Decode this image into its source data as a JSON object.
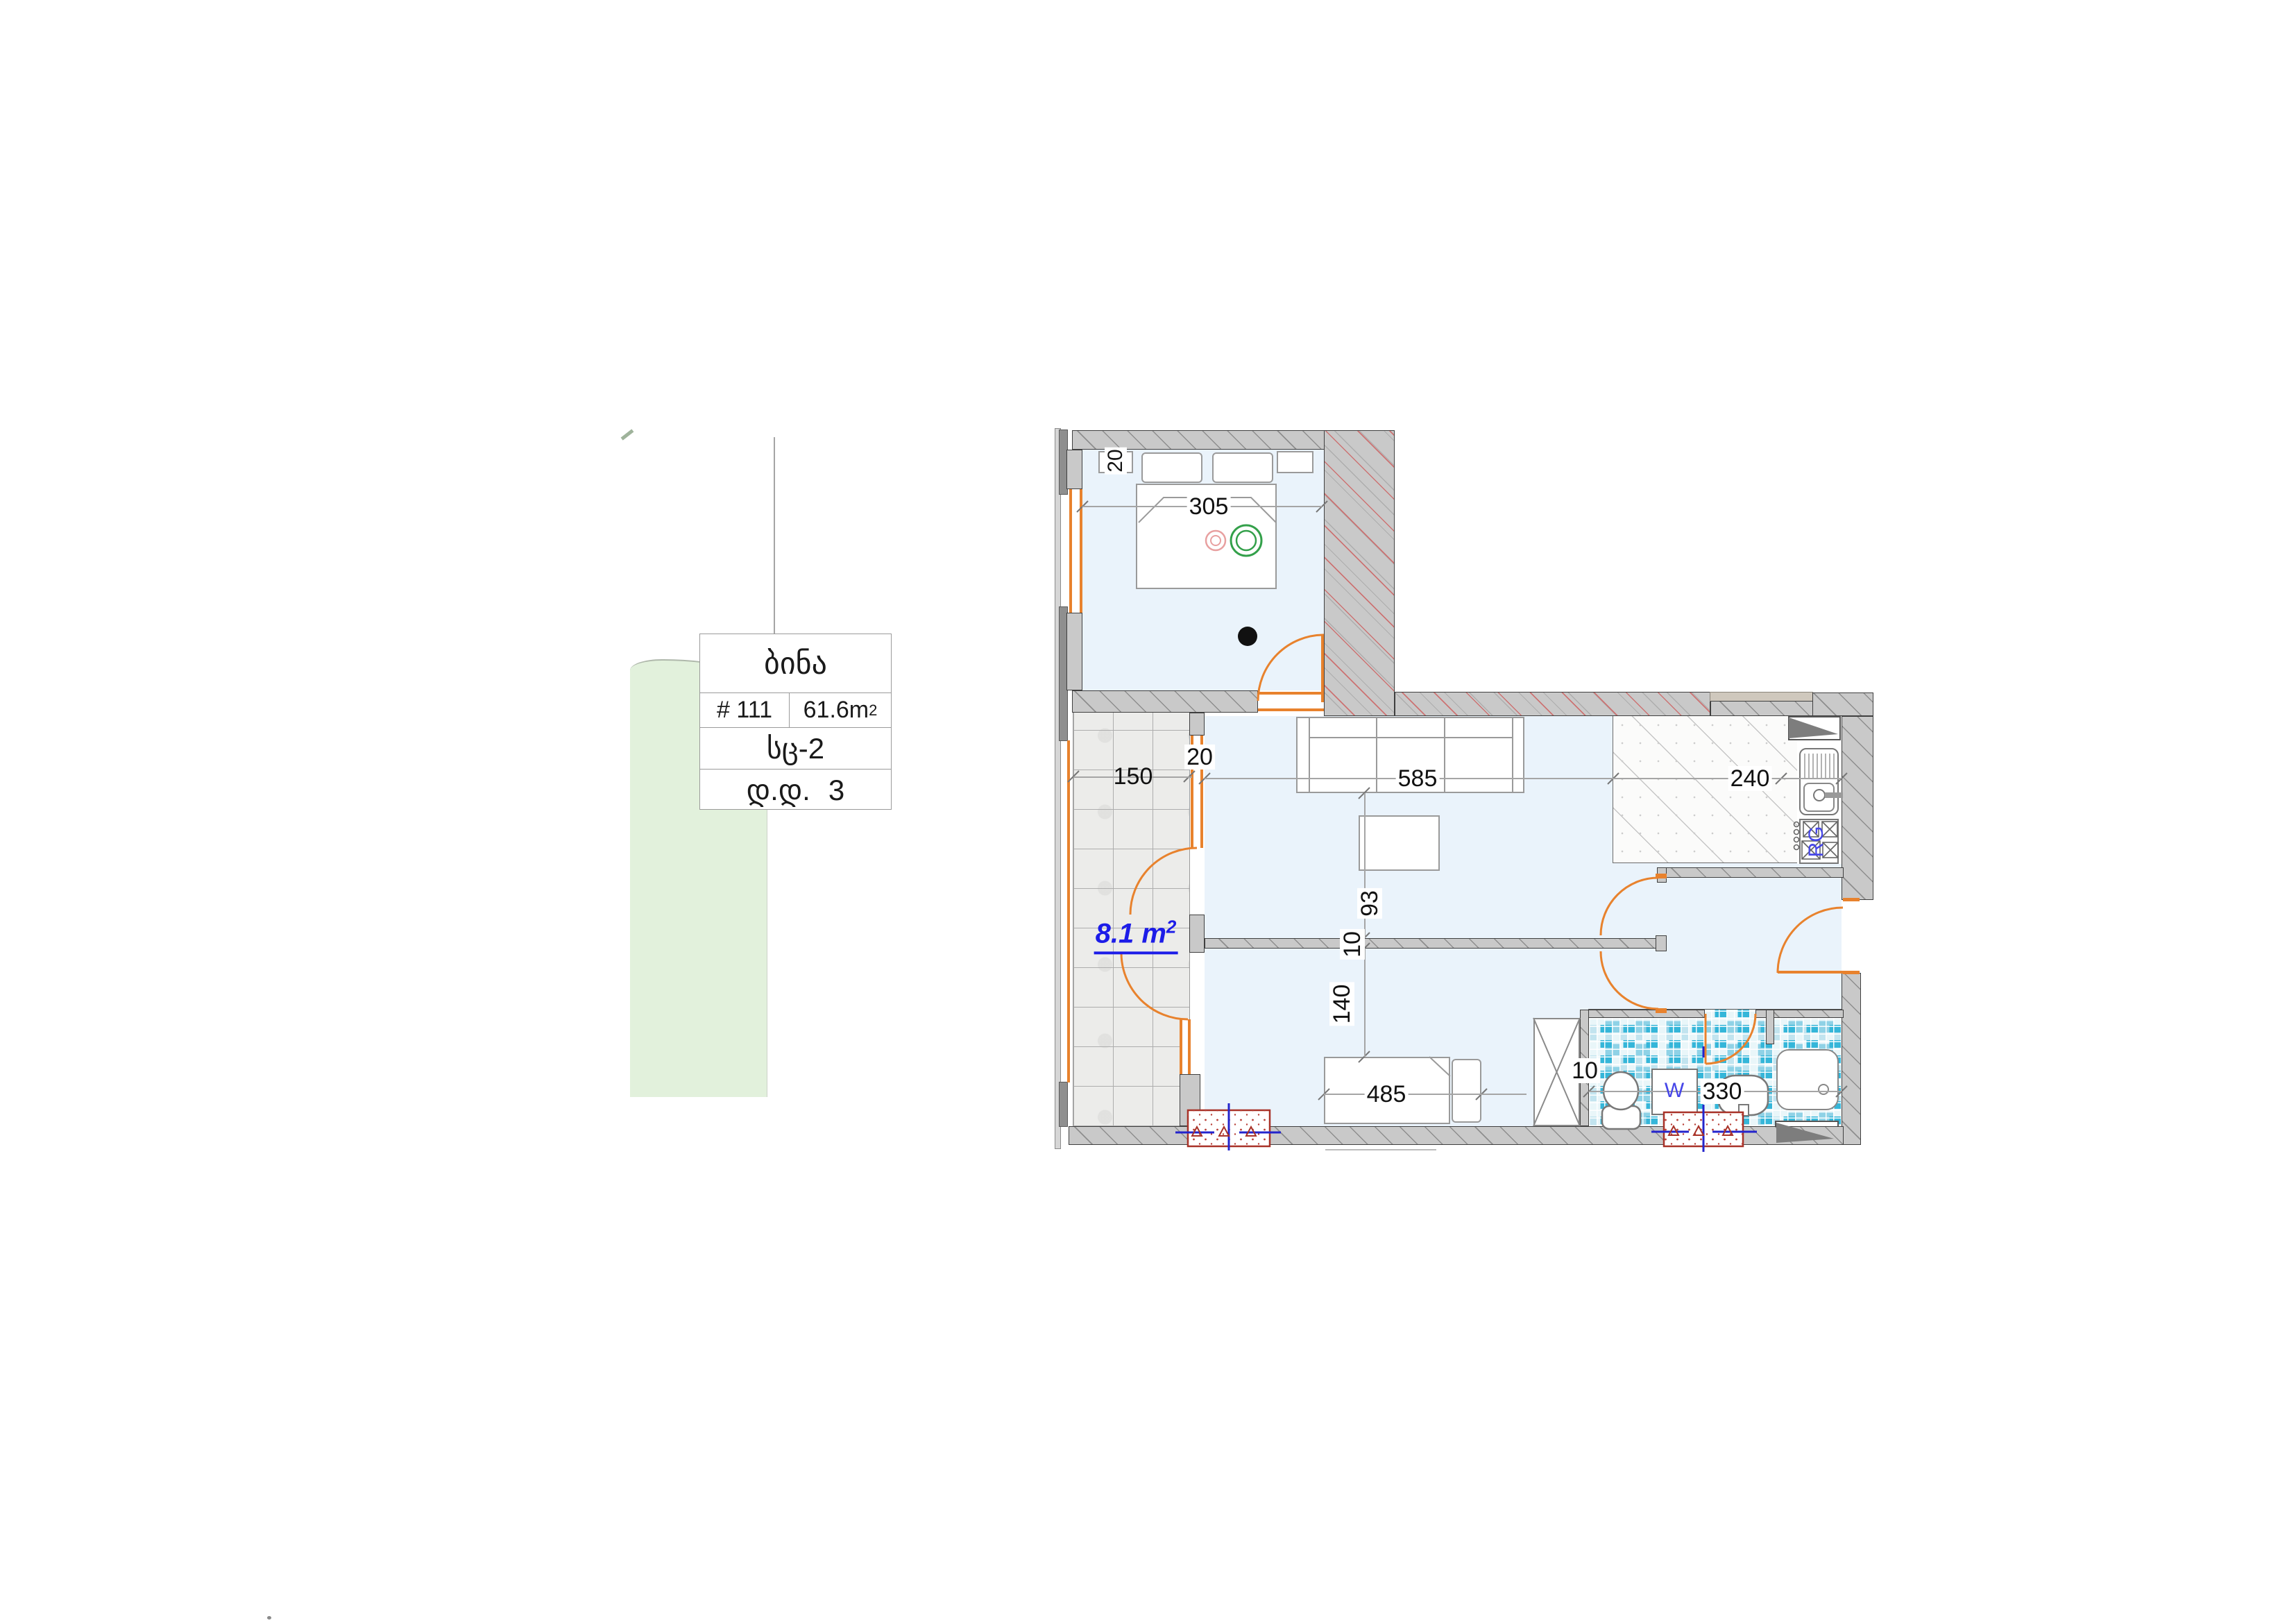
{
  "info_table": {
    "title": "ბინა",
    "apartment_number": "# 111",
    "area_value": "61.6m",
    "area_sup": "2",
    "section": "სც-2",
    "floor_prefix": "დ.დ.",
    "floor_number": "3"
  },
  "plan": {
    "balcony_area_value": "8.1 m",
    "balcony_area_sup": "2",
    "stove_label": "RG",
    "washer_label": "W",
    "dims": {
      "bedroom_width": "305",
      "top_wall_thickness": "20",
      "balcony_width": "150",
      "balcony_wall_thickness": "20",
      "living_width": "585",
      "kitchen_depth": "240",
      "sofa_clearance": "93",
      "partition_thickness": "10",
      "passage_width": "140",
      "bed_width": "485",
      "bath_wall_thickness": "10",
      "bathroom_width": "330"
    }
  },
  "colors": {
    "floor_blue": "#eaf3fb",
    "wall_gray": "#c9c9c9",
    "door_orange": "#e8822d",
    "mosaic_teal": "#35b6d9",
    "area_link_blue": "#1c1ce8",
    "green_lawn": "#e2f1dc",
    "shaft_red": "#a83228"
  }
}
